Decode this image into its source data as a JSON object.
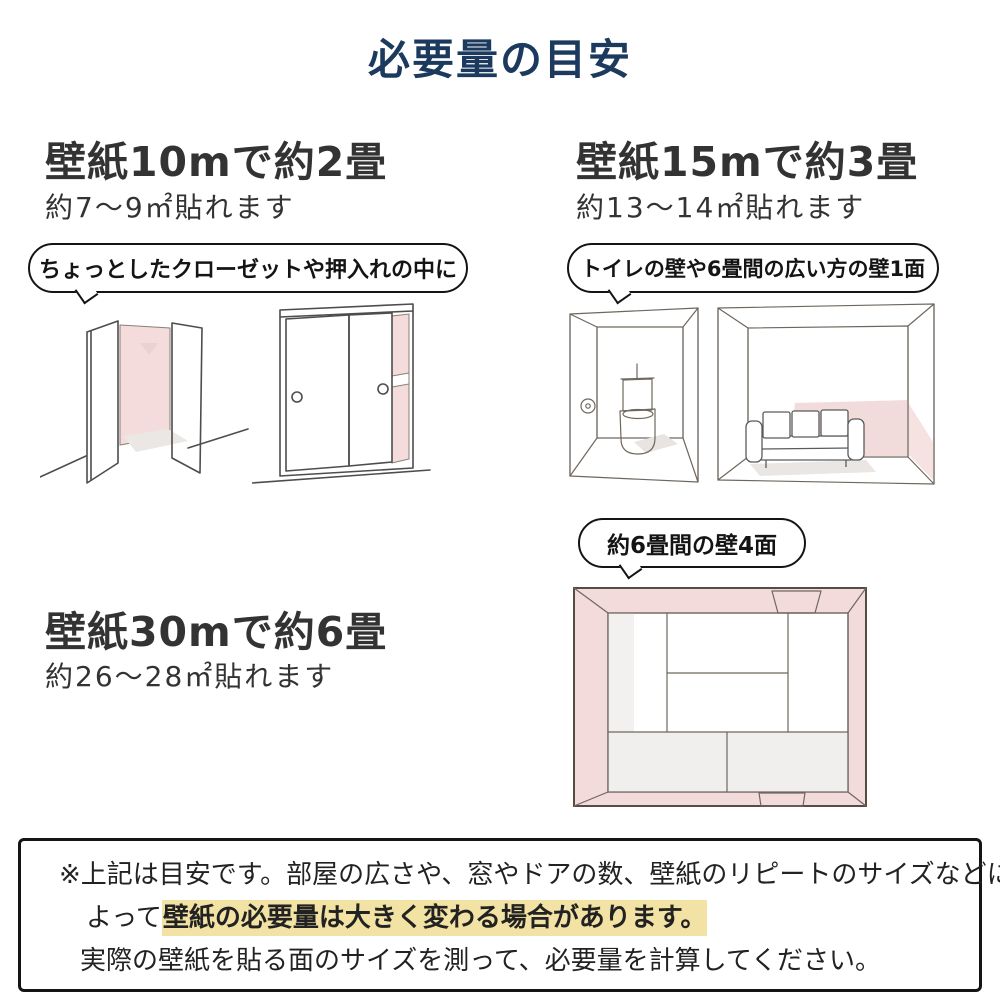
{
  "title": "必要量の目安",
  "colors": {
    "title_navy": "#1b3a5e",
    "heading_gray": "#333333",
    "highlight_yellow": "#f2e2a4",
    "wall_pink": "#f3dcdb",
    "wall_mauve": "#e5cecd",
    "wall_gray": "#ededeb",
    "outline_black": "#141414"
  },
  "sections": {
    "s10": {
      "heading": "壁紙10mで約2畳",
      "subtext": "約7〜9㎡貼れます",
      "bubble": "ちょっとしたクローゼットや押入れの中に"
    },
    "s15": {
      "heading": "壁紙15mで約3畳",
      "subtext": "約13〜14㎡貼れます",
      "bubble": "トイレの壁や6畳間の広い方の壁1面"
    },
    "s30": {
      "heading": "壁紙30mで約6畳",
      "subtext": "約26〜28㎡貼れます",
      "bubble": "約6畳間の壁4面"
    }
  },
  "illustrations": {
    "closet_open": "open-closet-sketch",
    "closet_sliding": "sliding-door-closet-sketch",
    "toilet_room": "toilet-room-sketch",
    "sofa_room": "six-mat-room-one-wall-sketch",
    "tatami_room": "six-mat-room-four-walls-top-view-sketch"
  },
  "note": {
    "line1": "※上記は目安です。部屋の広さや、窓やドアの数、壁紙のリピートのサイズなどに",
    "line2_prefix": "よって",
    "line2_highlight": "壁紙の必要量は大きく変わる場合があります。",
    "line3": "実際の壁紙を貼る面のサイズを測って、必要量を計算してください。"
  }
}
